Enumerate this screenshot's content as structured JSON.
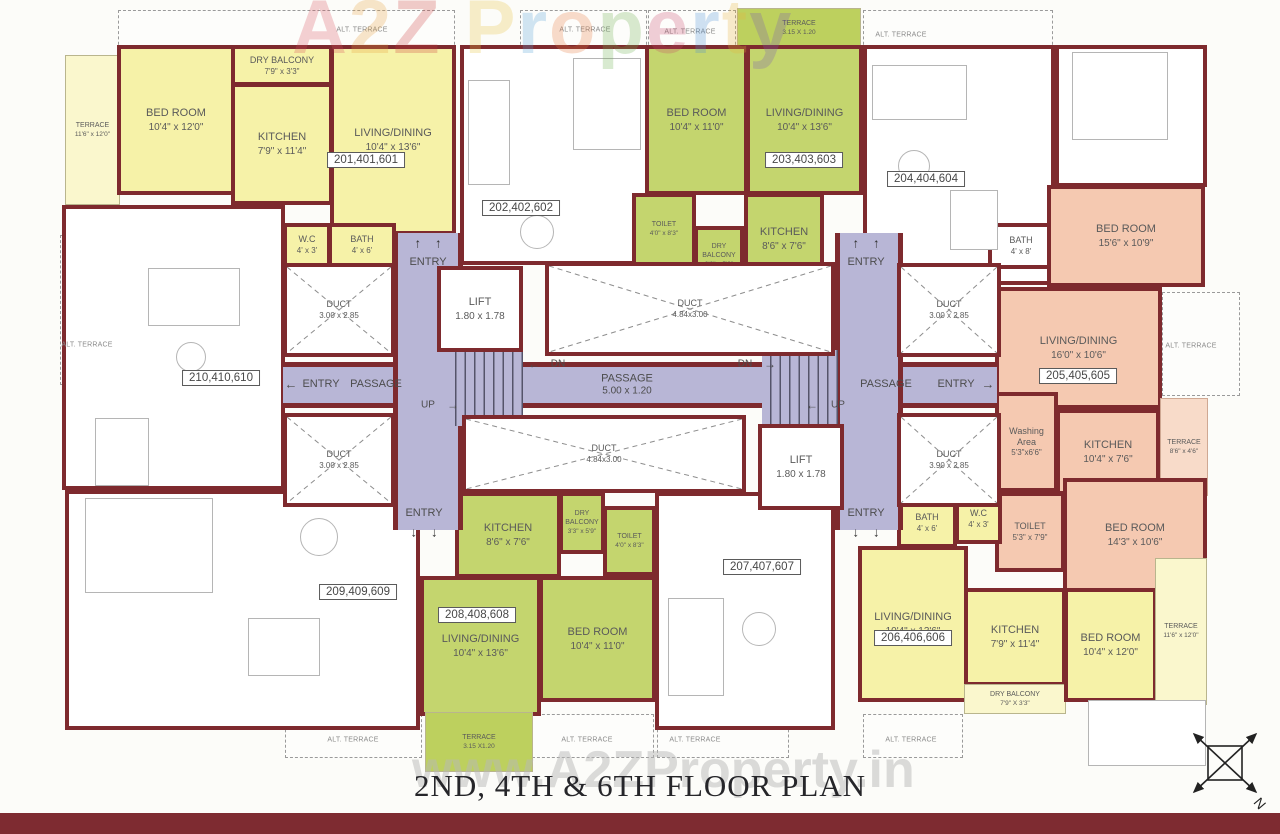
{
  "title": "2ND, 4TH & 6TH FLOOR PLAN",
  "watermarks": {
    "top": "A2Z Property",
    "bottom": "www.A2ZProperty.in"
  },
  "compass": {
    "north": "N"
  },
  "labels": {
    "alt_terrace": "ALT. TERRACE"
  },
  "core": {
    "entry": "ENTRY",
    "passage": "PASSAGE",
    "passage_dim": "5.00 x 1.20",
    "lift": "LIFT",
    "lift_dim": "1.80 x 1.78",
    "duct": "DUCT",
    "duct_dim_small": "3.00 x 2.85",
    "duct_dim_small_b": "3.90 x 2.85",
    "duct_dim_long": "4.84x3.00",
    "up": "UP",
    "dn": "DN",
    "arrow_up": "↑",
    "arrow_down": "↓",
    "arrow_left": "←",
    "arrow_right": "→"
  },
  "units": {
    "u201": {
      "no": "201,401,601",
      "terrace": {
        "name": "TERRACE",
        "dim": "11'6\" x 12'0\""
      },
      "bedroom": {
        "name": "BED ROOM",
        "dim": "10'4\" x 12'0\""
      },
      "dry_balcony": {
        "name": "DRY BALCONY",
        "dim": "7'9\" x 3'3\""
      },
      "kitchen": {
        "name": "KITCHEN",
        "dim": "7'9\" x 11'4\""
      },
      "living": {
        "name": "LIVING/DINING",
        "dim": "10'4\" x 13'6\""
      },
      "wc": {
        "name": "W.C",
        "dim": "4' x 3'"
      },
      "bath": {
        "name": "BATH",
        "dim": "4' x 6'"
      }
    },
    "u202": {
      "no": "202,402,602"
    },
    "u203": {
      "no": "203,403,603",
      "terrace": {
        "name": "TERRACE",
        "dim": "3.15 X 1.20"
      },
      "bedroom": {
        "name": "BED ROOM",
        "dim": "10'4\" x 11'0\""
      },
      "living": {
        "name": "LIVING/DINING",
        "dim": "10'4\" x 13'6\""
      },
      "toilet": {
        "name": "TOILET",
        "dim": "4'0\" x 8'3\""
      },
      "dry_balcony": {
        "name": "DRY BALCONY",
        "dim": "3'3\" x 5'9\""
      },
      "kitchen": {
        "name": "KITCHEN",
        "dim": "8'6\" x 7'6\""
      }
    },
    "u204": {
      "no": "204,404,604",
      "bath": {
        "name": "BATH",
        "dim": "4' x 8'"
      }
    },
    "u205": {
      "no": "205,405,605",
      "bedroom_top": {
        "name": "BED ROOM",
        "dim": "15'6\" x 10'9\""
      },
      "living": {
        "name": "LIVING/DINING",
        "dim": "16'0\" x 10'6\""
      },
      "washing": {
        "name": "Washing Area",
        "dim": "5'3\"x6'6\""
      },
      "kitchen": {
        "name": "KITCHEN",
        "dim": "10'4\" x 7'6\""
      },
      "terrace": {
        "name": "TERRACE",
        "dim": "8'6\" x 4'6\""
      },
      "toilet": {
        "name": "TOILET",
        "dim": "5'3\" x 7'9\""
      },
      "bedroom_bottom": {
        "name": "BED ROOM",
        "dim": "14'3\" x 10'6\""
      }
    },
    "u206": {
      "no": "206,406,606",
      "bath": {
        "name": "BATH",
        "dim": "4' x 6'"
      },
      "wc": {
        "name": "W.C",
        "dim": "4' x 3'"
      },
      "living": {
        "name": "LIVING/DINING",
        "dim": "10'4\" x 13'6\""
      },
      "kitchen": {
        "name": "KITCHEN",
        "dim": "7'9\" x 11'4\""
      },
      "dry_balcony": {
        "name": "DRY BALCONY",
        "dim": "7'9\" X 3'3\""
      },
      "bedroom": {
        "name": "BED ROOM",
        "dim": "10'4\" x 12'0\""
      },
      "terrace": {
        "name": "TERRACE",
        "dim": "11'6\" x 12'0\""
      }
    },
    "u207": {
      "no": "207,407,607"
    },
    "u208": {
      "no": "208,408,608",
      "kitchen": {
        "name": "KITCHEN",
        "dim": "8'6\" x 7'6\""
      },
      "dry_balcony": {
        "name": "DRY BALCONY",
        "dim": "3'3\" x 5'9\""
      },
      "toilet": {
        "name": "TOILET",
        "dim": "4'0\" x 8'3\""
      },
      "living": {
        "name": "LIVING/DINING",
        "dim": "10'4\" x 13'6\""
      },
      "bedroom": {
        "name": "BED ROOM",
        "dim": "10'4\" x 11'0\""
      },
      "terrace": {
        "name": "TERRACE",
        "dim": "3.15 X1.20"
      }
    },
    "u209": {
      "no": "209,409,609"
    },
    "u210": {
      "no": "210,410,610"
    }
  }
}
